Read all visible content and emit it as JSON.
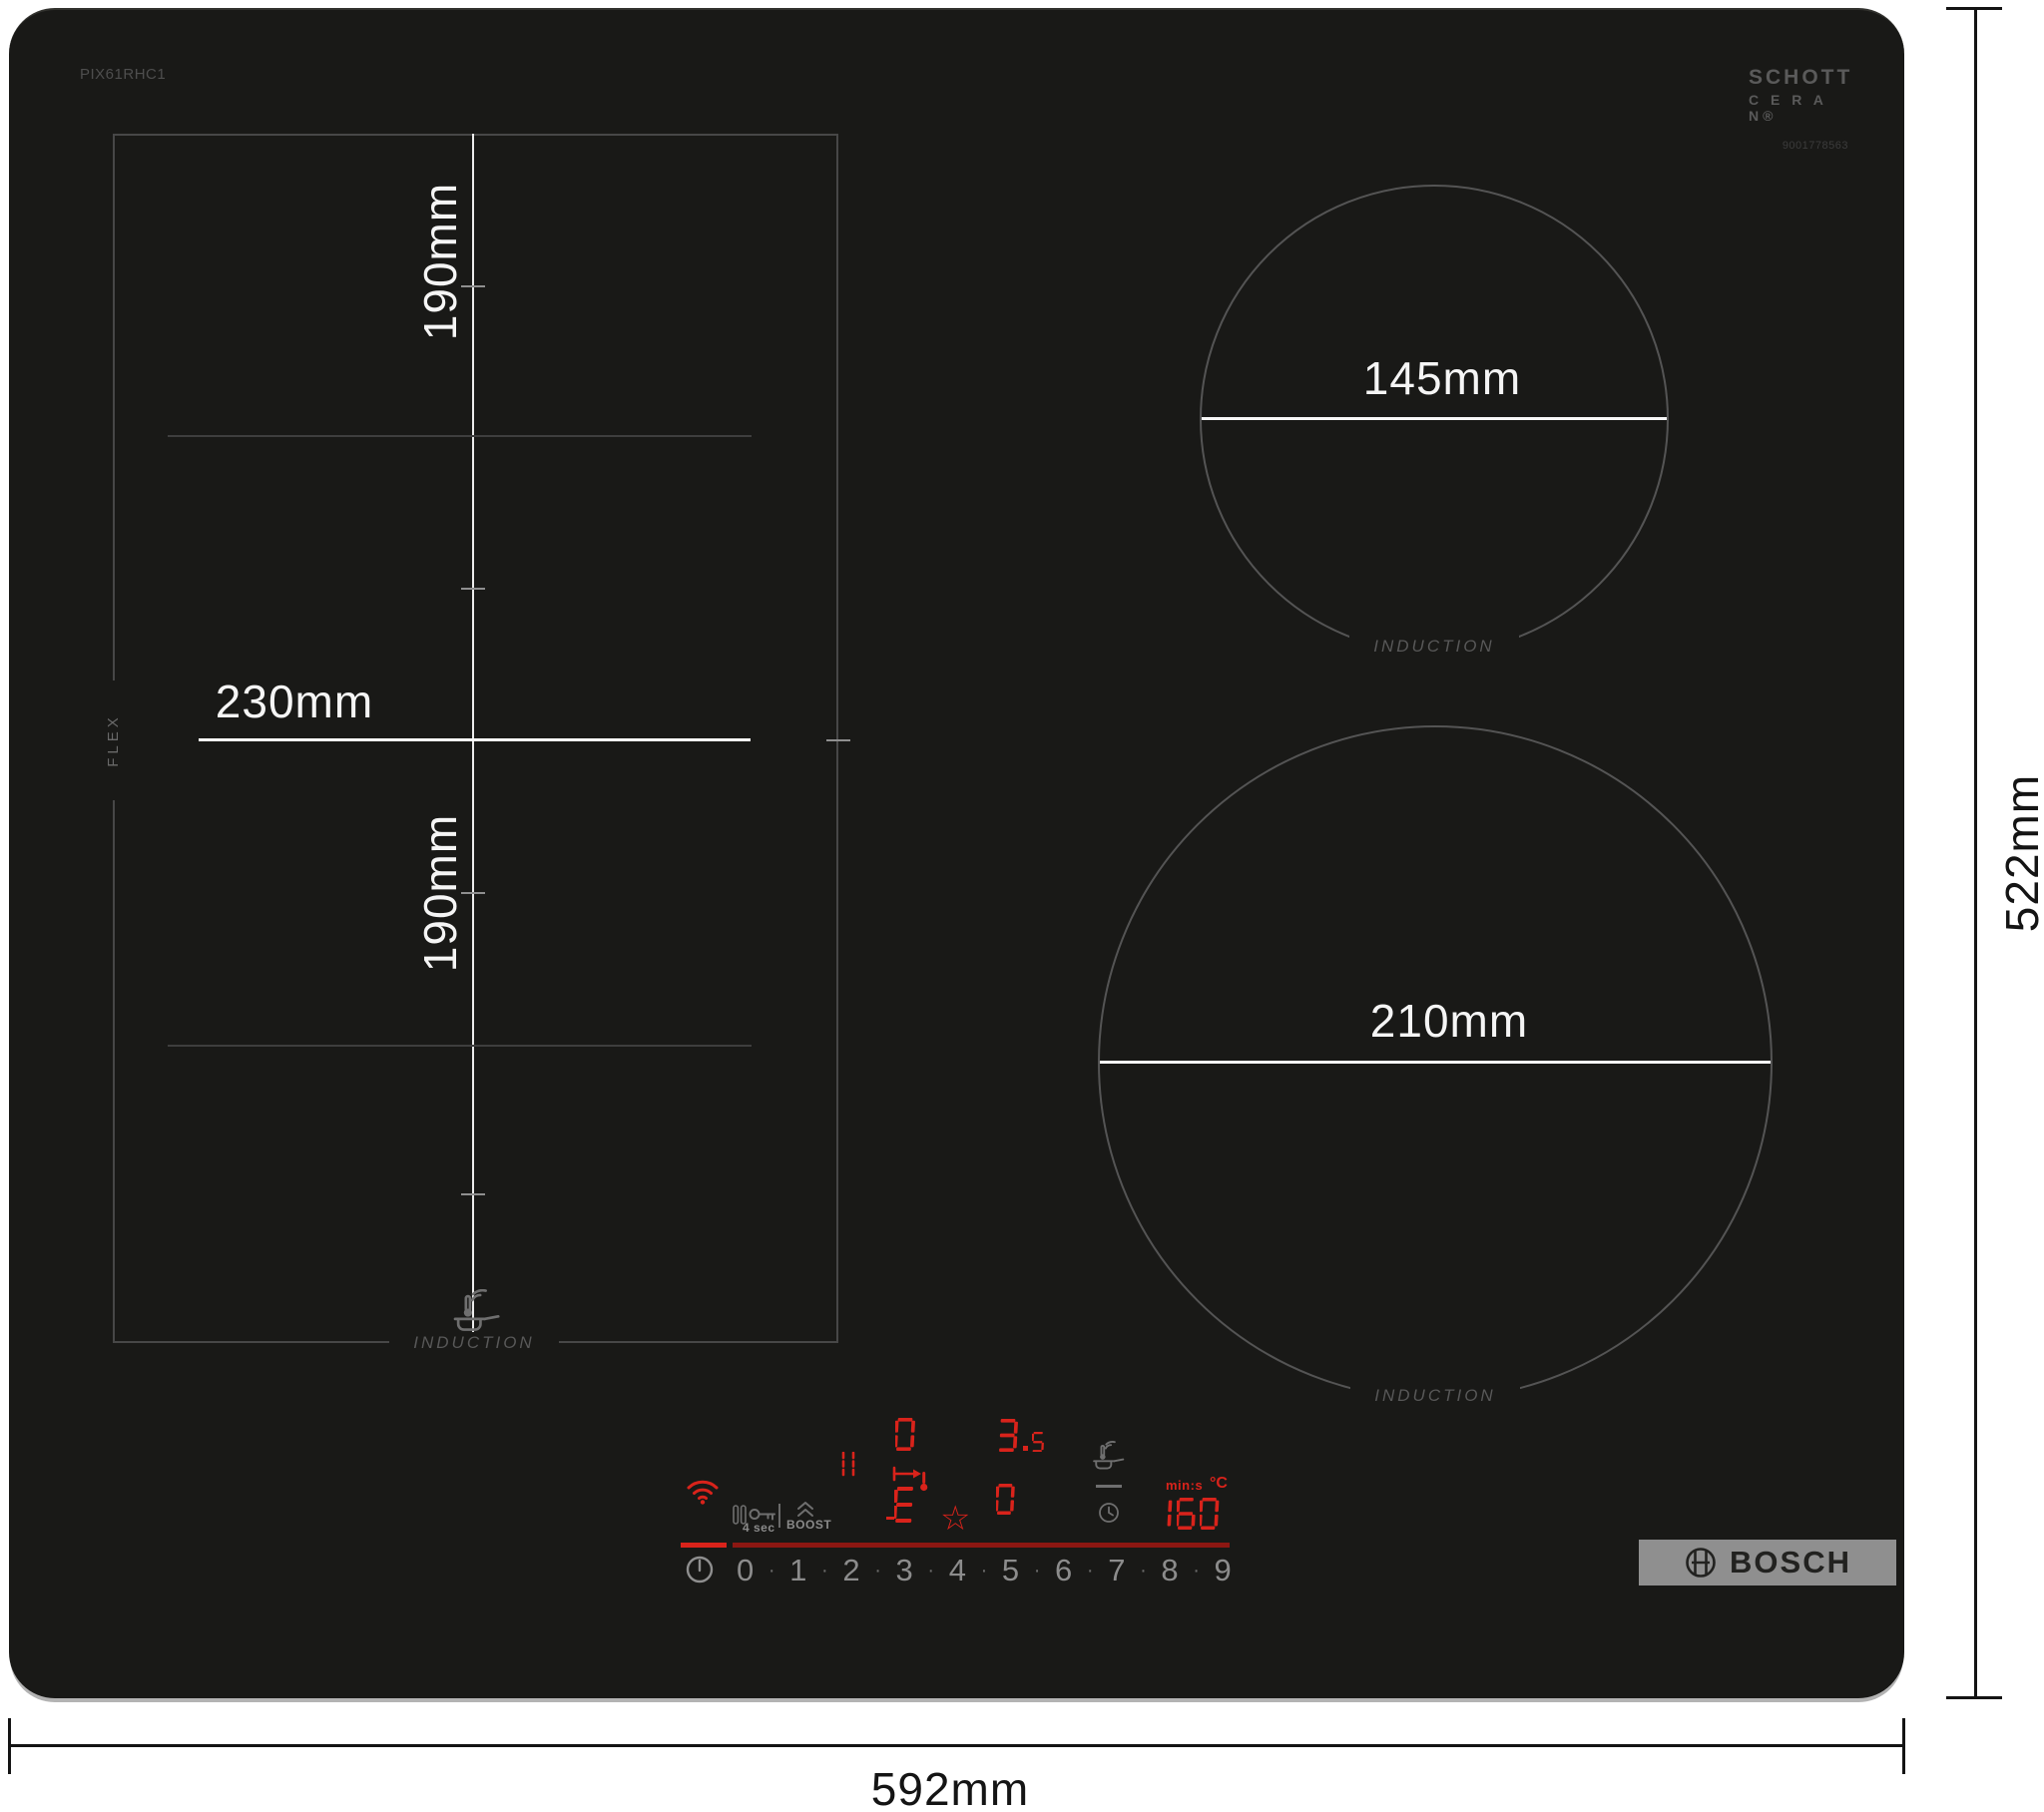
{
  "product": {
    "model": "PIX61RHC1",
    "glass_logo_line1": "SCHOTT",
    "glass_logo_line2": "C E R A N®",
    "glass_serial": "9001778563",
    "brand": "BOSCH"
  },
  "overall_dimensions": {
    "width": "592mm",
    "height": "522mm"
  },
  "flex_zone": {
    "label": "FLEX",
    "upper_width": "190mm",
    "lower_width": "190mm",
    "depth": "230mm",
    "technology": "INDUCTION"
  },
  "zones": {
    "small": {
      "diameter": "145mm",
      "technology": "INDUCTION"
    },
    "large": {
      "diameter": "210mm",
      "technology": "INDUCTION"
    }
  },
  "control_panel": {
    "child_lock_label": "4 sec",
    "boost_label": "BOOST",
    "flex_display_power": "0",
    "flex_display_aux": "3.5",
    "flex_display_mode": "E",
    "right_display_power": "0",
    "timer_value": "160",
    "timer_unit": "min:s",
    "temp_unit": "°C",
    "power_scale": [
      "0",
      "1",
      "2",
      "3",
      "4",
      "5",
      "6",
      "7",
      "8",
      "9"
    ],
    "power_scale_separator": "·"
  },
  "colors": {
    "led_red": "#d9231b",
    "led_dim_red": "#8c1712",
    "surface_black": "#191917",
    "outline_grey": "#545454",
    "dimension_white": "#f5f5f5"
  }
}
